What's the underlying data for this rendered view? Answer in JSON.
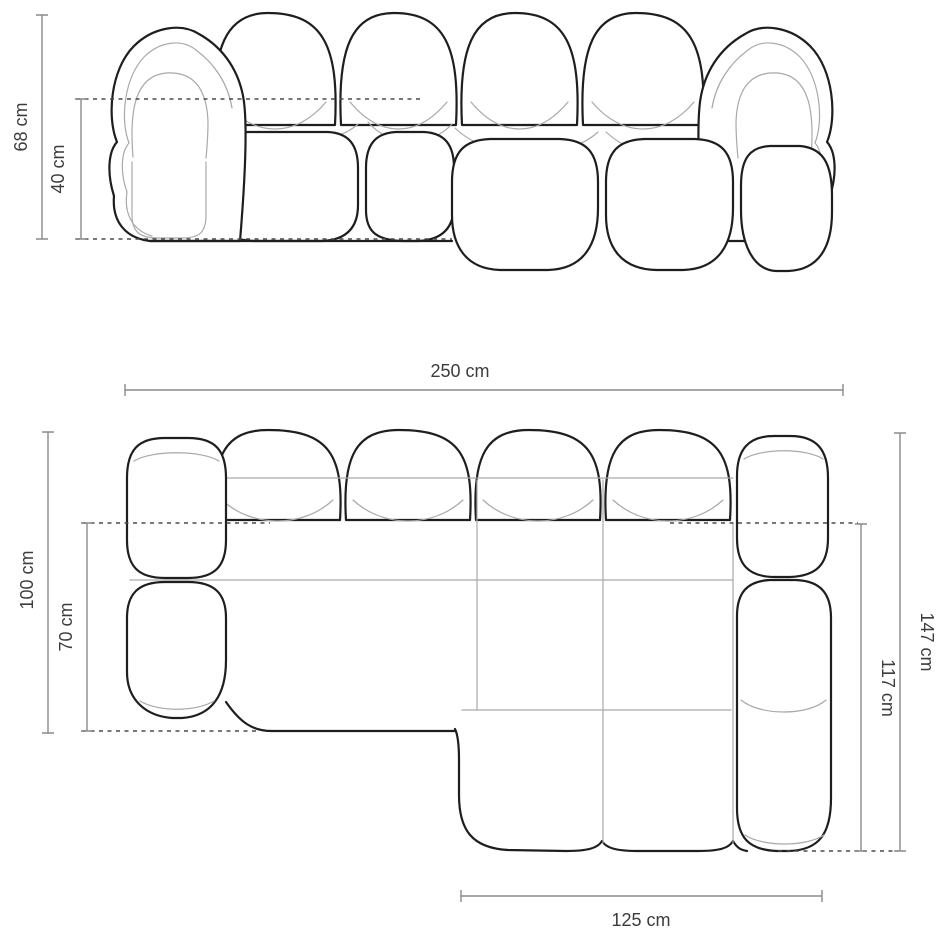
{
  "diagram": {
    "type": "furniture-dimension-drawing",
    "product": "modular-chaise-sofa",
    "front_view": {
      "height_total": "68 cm",
      "height_seat": "40 cm"
    },
    "top_view": {
      "width_total": "250 cm",
      "depth_total": "100 cm",
      "depth_seat": "70 cm",
      "chaise_length_total": "147 cm",
      "chaise_length_inner": "117 cm",
      "chaise_width": "125 cm"
    },
    "colors": {
      "background": "#ffffff",
      "outline": "#1e1e1e",
      "seam": "#a9a9a9",
      "dimension_line": "#8a8a8a",
      "dashed_guide": "#4a4a4a",
      "label_text": "#3c3c3c"
    }
  }
}
